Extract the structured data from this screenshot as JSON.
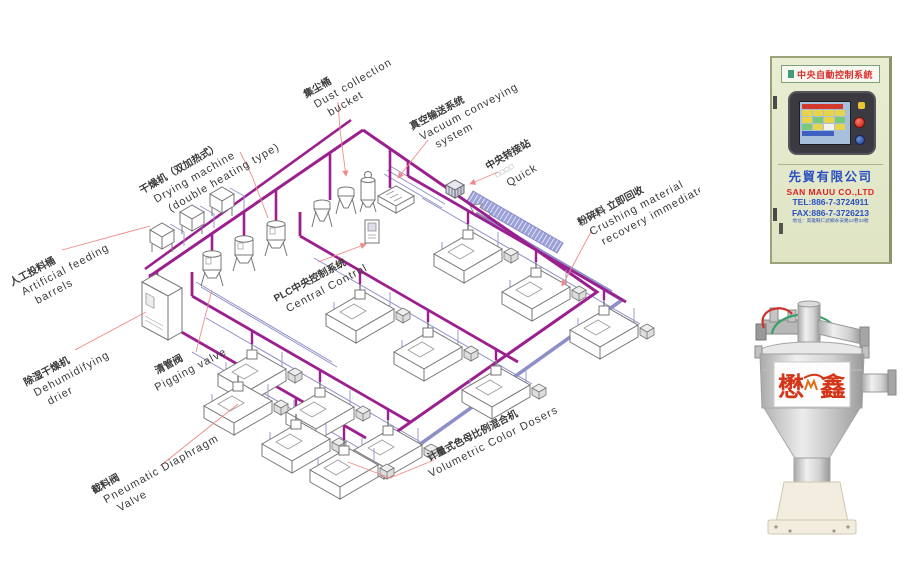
{
  "diagram": {
    "labels": [
      {
        "zh": "人工投料桶",
        "en1": "Artificial feeding",
        "en2": "barrels"
      },
      {
        "zh": "干燥机（双加热式）",
        "en1": "Drying machine",
        "en2": "(double heating type)"
      },
      {
        "zh": "集尘桶",
        "en1": "Dust collection",
        "en2": "bucket"
      },
      {
        "zh": "真空输送系统",
        "en1": "Vacuum conveying",
        "en2": "system"
      },
      {
        "zh": "中央转接站",
        "en1": "□□□□",
        "en2": "Quick"
      },
      {
        "zh": "PLC中央控制系统",
        "en1": "Central Control",
        "en2": ""
      },
      {
        "zh": "粉碎料 立即回收",
        "en1": "Crushing material",
        "en2": "recovery immediately"
      },
      {
        "zh": "除湿干燥机",
        "en1": "Dehumidifying",
        "en2": "drier"
      },
      {
        "zh": "清管阀",
        "en1": "Pigging valve",
        "en2": ""
      },
      {
        "zh": "截料阀",
        "en1": "Pneumatic Diaphragm",
        "en2": "Valve"
      },
      {
        "zh": "计量式色母比例混合机",
        "en1": "Volumetric Color Dosers",
        "en2": ""
      }
    ],
    "colors": {
      "pipe_purple": "#9b1f8f",
      "pipe_blue": "#8f8fc8",
      "leader_red": "#ef8a8a"
    }
  },
  "cabinet_photo": {
    "banner": "中央自動控制系統",
    "company_zh": "先貿有限公司",
    "company_en": "SAN MAUU CO.,LTD",
    "tel": "TEL:886-7-3724911",
    "fax": "FAX:886-7-3726213",
    "address": "地址：高雄縣仁武鄉永安路12巷33號",
    "colors": {
      "body": "#e5e9cc",
      "banner_text": "#d93030",
      "company_zh": "#2a4fc2",
      "company_en": "#e02222",
      "contact": "#2a4fc2"
    }
  },
  "hopper_photo": {
    "brand_left": "懋",
    "brand_right": "鑫"
  }
}
